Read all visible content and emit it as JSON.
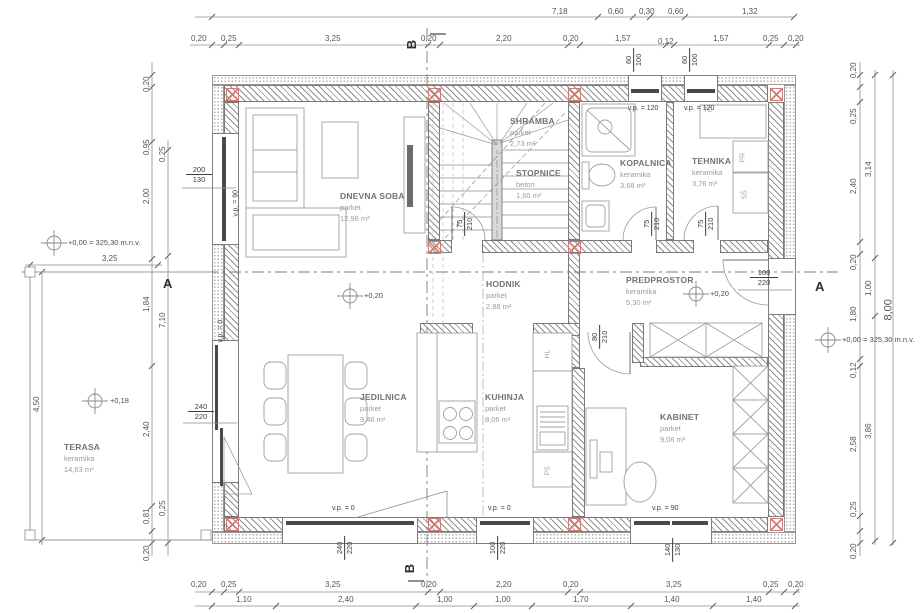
{
  "rooms": {
    "dnevna_soba": {
      "name": "DNEVNA SOBA",
      "material": "parket",
      "area": "12,96 m²"
    },
    "shramba": {
      "name": "SHRAMBA",
      "material": "parket",
      "area": "2,73 m²"
    },
    "stopnice": {
      "name": "STOPNICE",
      "material": "beton",
      "area": "1,60 m²"
    },
    "kopalnica": {
      "name": "KOPALNICA",
      "material": "keramika",
      "area": "3,68 m²"
    },
    "tehnika": {
      "name": "TEHNIKA",
      "material": "keramika",
      "area": "3,76 m²"
    },
    "hodnik": {
      "name": "HODNIK",
      "material": "parket",
      "area": "2,88 m²"
    },
    "predprostor": {
      "name": "PREDPROSTOR",
      "material": "keramika",
      "area": "5,30 m²"
    },
    "jedilnica": {
      "name": "JEDILNICA",
      "material": "parket",
      "area": "9,46 m²"
    },
    "kuhinja": {
      "name": "KUHINJA",
      "material": "parket",
      "area": "8,06 m²"
    },
    "kabinet": {
      "name": "KABINET",
      "material": "parket",
      "area": "9,06 m²"
    },
    "terasa": {
      "name": "TERASA",
      "material": "keramika",
      "area": "14,63 m²"
    }
  },
  "levels": {
    "datum_left": "+0,00 = 325,30 m.n.v.",
    "datum_right": "+0,00 = 325,30 m.n.v.",
    "hodnik": "+0,20",
    "predprostor": "+0,20",
    "terasa": "+0,18"
  },
  "sections": {
    "a": "A",
    "b": "B"
  },
  "appliances": {
    "tc": "TČ",
    "pr": "PR.",
    "ss": "SŠ",
    "hl": "HL",
    "ps": "PS"
  },
  "openings": {
    "living_window": {
      "w": "200",
      "h": "130",
      "sill": "v.p. = 90"
    },
    "terrace_door": {
      "w": "240",
      "h": "220",
      "sill": "v.p. = 0"
    },
    "top_window_1": {
      "w": "60",
      "h": "100",
      "sill": "v.p. = 120"
    },
    "top_window_2": {
      "w": "60",
      "h": "100",
      "sill": "v.p. = 120"
    },
    "stairs_door": {
      "w": "75",
      "h": "210"
    },
    "bath_door": {
      "w": "75",
      "h": "210"
    },
    "tech_door": {
      "w": "75",
      "h": "210"
    },
    "cabinet_door": {
      "w": "80",
      "h": "210"
    },
    "entrance_door": {
      "w": "100",
      "h": "220"
    },
    "dining_door": {
      "w": "240",
      "h": "220",
      "sill": "v.p. = 0"
    },
    "kitchen_window": {
      "w": "100",
      "h": "220",
      "sill": "v.p. = 0"
    },
    "cabinet_window": {
      "w": "140",
      "h": "130",
      "sill": "v.p. = 90"
    }
  },
  "dims": {
    "top1": [
      "7,18",
      "0,60",
      "0,30",
      "0,60",
      "1,32"
    ],
    "top2": [
      "0,20",
      "0,25",
      "3,25",
      "0,20",
      "2,20",
      "0,20",
      "1,57",
      "0,12",
      "1,57",
      "0,25",
      "0,20"
    ],
    "bottom1": [
      "0,20",
      "0,25",
      "3,25",
      "0,20",
      "2,20",
      "0,20",
      "3,25",
      "0,25",
      "0,20"
    ],
    "bottom2": [
      "1,10",
      "2,40",
      "1,00",
      "1,00",
      "1,70",
      "1,40",
      "1,40"
    ],
    "left1": [
      "0,20",
      "0,95",
      "2,00",
      "1,84",
      "2,40",
      "0,81",
      "0,20"
    ],
    "left2": [
      "0,25",
      "7,10",
      "0,25"
    ],
    "right1": [
      "0,20",
      "0,25",
      "2,40",
      "0,20",
      "1,80",
      "0,12",
      "2,58",
      "0,25",
      "0,20"
    ],
    "right2": [
      "3,14",
      "1,00",
      "3,86"
    ],
    "right_total": "8,00",
    "terrace_width": "3,25",
    "terrace_height": "4,50"
  }
}
